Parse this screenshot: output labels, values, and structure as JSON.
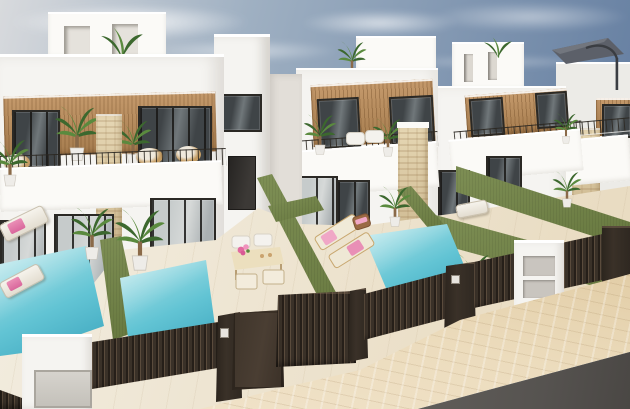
{
  "scene": {
    "description": "Architectural 3D render of a row of modern white two-storey villas with rooftop terraces, wood-slat cladding accents, balconies with thin metal railings, private backyards with turquoise plunge pools, olive-green artificial-grass topped dividing walls, dark brown slatted street fences and gates, a beige tiled sidewalk and asphalt road in the lower right, under a soft blue sky",
    "time_of_day": "day",
    "counts": {
      "villas": 5,
      "rooftop_boxes": 4,
      "pools": 3,
      "sun_loungers": 5,
      "dining_chairs": 4,
      "gates": 2,
      "potted_plants": 12
    },
    "objects": [
      "sky",
      "clouds",
      "villa-row",
      "rooftop-terrace-box",
      "parasol",
      "wood-cladding",
      "balcony-railing",
      "travertine-pillar",
      "glass-door",
      "plunge-pool",
      "artificial-grass-wall",
      "dark-slat-fence",
      "pedestrian-gate",
      "driveway-gate",
      "utility-cabinet",
      "white-entry-pillar",
      "dining-set",
      "pink-flowers",
      "sun-lounger",
      "pink-towel",
      "potted-palm",
      "sidewalk",
      "road"
    ]
  },
  "palette": {
    "sky_top": "#6a83a4",
    "sky_mid": "#9fb0c2",
    "sky_low": "#d8dadd",
    "cloud": "#f3f4f5",
    "wall": "#f5f4f1",
    "wall_bright": "#fbfaf7",
    "wall_dim": "#ecebe7",
    "wall_shade": "#e2ded8",
    "wood": "#c59a6c",
    "wood_dark": "#a57c4e",
    "frame": "#2b2925",
    "glass_dark": "#3f4447",
    "glass_mid": "#70777a",
    "glass_light": "#d6d9d8",
    "travertine": "#e6d7b4",
    "travertine_dark": "#d0bc94",
    "grass": "#7e8f55",
    "grass_dark": "#66773e",
    "pool_light": "#aee3e8",
    "pool_mid": "#62c4d4",
    "pool_deep": "#3da6be",
    "terrace": "#f3eee2",
    "terrace_dark": "#e9dcc2",
    "fence": "#3a3128",
    "fence_hi": "#5a4b3c",
    "gate_panel": "#4a3e33",
    "sidewalk": "#ecdcbd",
    "road": "#565350",
    "pink": "#ea8fb6",
    "leaf": "#5a8a3e",
    "leaf_dark": "#3c682e",
    "trunk": "#8a6a49",
    "pot": "#eeece8",
    "panel": "#c9c5bf",
    "door_gray": "#d6d3cd",
    "wicker": "#c49c63",
    "parasol": "#5c6069"
  }
}
